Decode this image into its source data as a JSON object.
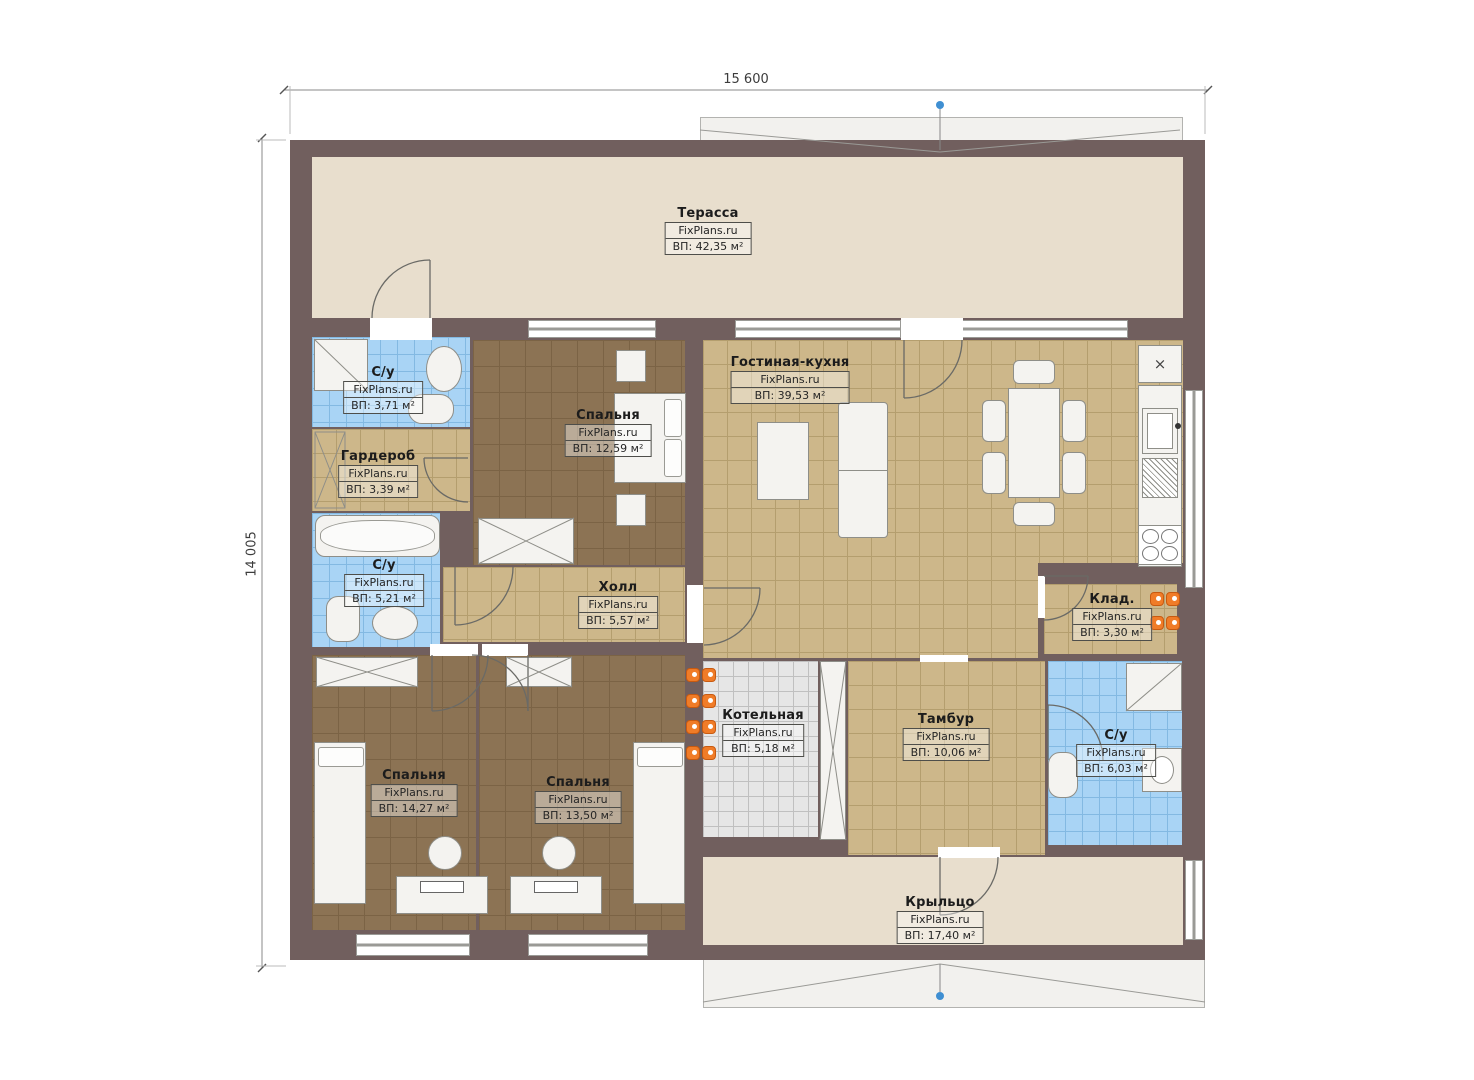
{
  "plan": {
    "brand": "FixPlans.ru",
    "dimensions": {
      "top": "15 600",
      "left": "14 005"
    },
    "icons": {
      "vent_cross": "×"
    },
    "colors": {
      "wall": "#715f5e",
      "floor_beige": "#e8decd",
      "tile_tan": "#cdb78a",
      "floor_brown": "#8c7354",
      "tile_blue": "#a9d4f5",
      "tile_gray": "#e6e6e6",
      "radiator": "#f07c28",
      "marker_blue": "#3f8fd2"
    },
    "rooms": [
      {
        "id": "terrace",
        "name": "Терасса",
        "area": "ВП: 42,35 м²"
      },
      {
        "id": "bath-top",
        "name": "С/у",
        "area": "ВП: 3,71 м²"
      },
      {
        "id": "wardrobe",
        "name": "Гардероб",
        "area": "ВП: 3,39 м²"
      },
      {
        "id": "bedroom-top",
        "name": "Спальня",
        "area": "ВП: 12,59 м²"
      },
      {
        "id": "living",
        "name": "Гостиная-кухня",
        "area": "ВП: 39,53 м²"
      },
      {
        "id": "bath-left",
        "name": "С/у",
        "area": "ВП: 5,21 м²"
      },
      {
        "id": "hall",
        "name": "Холл",
        "area": "ВП: 5,57 м²"
      },
      {
        "id": "storage",
        "name": "Клад.",
        "area": "ВП: 3,30 м²"
      },
      {
        "id": "boiler",
        "name": "Котельная",
        "area": "ВП: 5,18 м²"
      },
      {
        "id": "tambour",
        "name": "Тамбур",
        "area": "ВП: 10,06 м²"
      },
      {
        "id": "bath-right",
        "name": "С/у",
        "area": "ВП: 6,03 м²"
      },
      {
        "id": "bedroom-left",
        "name": "Спальня",
        "area": "ВП: 14,27 м²"
      },
      {
        "id": "bedroom-mid",
        "name": "Спальня",
        "area": "ВП: 13,50 м²"
      },
      {
        "id": "porch",
        "name": "Крыльцо",
        "area": "ВП: 17,40 м²"
      }
    ]
  }
}
